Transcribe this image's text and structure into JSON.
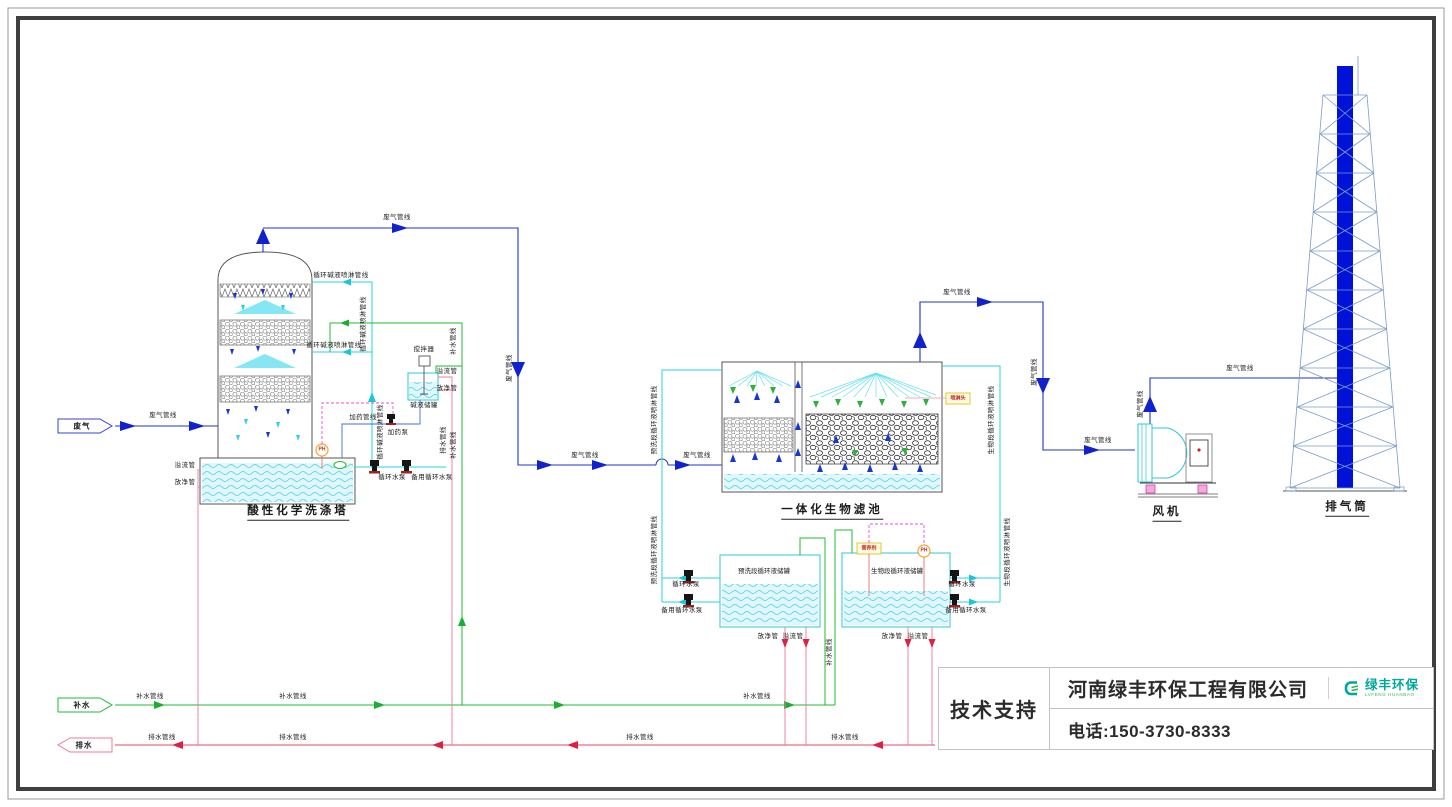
{
  "title_block": {
    "support": "技术支持",
    "company": "河南绿丰环保工程有限公司",
    "phone": "电话:150-3730-8333",
    "logo_text": "绿丰环保",
    "logo_sub": "LVFENG HUANBAO"
  },
  "colors": {
    "gas_line": "#2233cc",
    "circulation_line": "#27d3e0",
    "water_line": "#22bb33",
    "drain_line": "#e8446a",
    "signal_line": "#e24fe2",
    "stack_fill": "#0011d8",
    "logo_teal": "#00a79b",
    "logo_green": "#3ab54a"
  },
  "diagram_labels": [
    {
      "t": "废气",
      "x": 82,
      "y": 426,
      "k": "flag",
      "n": "flag-waste-gas-in"
    },
    {
      "t": "补水",
      "x": 82,
      "y": 705,
      "k": "flag",
      "n": "flag-water-in"
    },
    {
      "t": "排水",
      "x": 84,
      "y": 745,
      "k": "flag",
      "n": "flag-drain-out"
    },
    {
      "t": "废气管线",
      "x": 163,
      "y": 416,
      "n": "gas-line-label"
    },
    {
      "t": "废气管线",
      "x": 397,
      "y": 218,
      "n": "gas-line-label"
    },
    {
      "t": "废气管线",
      "x": 510,
      "y": 368,
      "r": 1,
      "n": "gas-line-label"
    },
    {
      "t": "废气管线",
      "x": 585,
      "y": 456,
      "n": "gas-line-label"
    },
    {
      "t": "废气管线",
      "x": 697,
      "y": 456,
      "n": "gas-line-label"
    },
    {
      "t": "废气管线",
      "x": 957,
      "y": 293,
      "n": "gas-line-label"
    },
    {
      "t": "废气管线",
      "x": 1035,
      "y": 372,
      "r": 1,
      "n": "gas-line-label"
    },
    {
      "t": "废气管线",
      "x": 1098,
      "y": 441,
      "n": "gas-line-label"
    },
    {
      "t": "废气管线",
      "x": 1141,
      "y": 404,
      "r": 1,
      "n": "gas-line-label"
    },
    {
      "t": "废气管线",
      "x": 1240,
      "y": 369,
      "n": "gas-line-label"
    },
    {
      "t": "循环碱液喷淋管线",
      "x": 341,
      "y": 276,
      "n": "alkali-spray-line-label"
    },
    {
      "t": "循环碱液喷淋管线",
      "x": 334,
      "y": 346,
      "n": "alkali-spray-line-label"
    },
    {
      "t": "循环碱液喷淋管线",
      "x": 364,
      "y": 324,
      "r": 1,
      "n": "alkali-spray-line-label"
    },
    {
      "t": "循环碱液喷淋管线",
      "x": 381,
      "y": 432,
      "r": 1,
      "n": "alkali-spray-line-label"
    },
    {
      "t": "补水管线",
      "x": 454,
      "y": 341,
      "r": 1,
      "n": "makeup-water-label"
    },
    {
      "t": "补水管线",
      "x": 454,
      "y": 445,
      "r": 1,
      "n": "makeup-water-label"
    },
    {
      "t": "补水管线",
      "x": 830,
      "y": 652,
      "r": 1,
      "n": "makeup-water-label"
    },
    {
      "t": "补水管线",
      "x": 150,
      "y": 697,
      "n": "makeup-water-label"
    },
    {
      "t": "补水管线",
      "x": 293,
      "y": 697,
      "n": "makeup-water-label"
    },
    {
      "t": "补水管线",
      "x": 757,
      "y": 697,
      "n": "makeup-water-label"
    },
    {
      "t": "排水管线",
      "x": 162,
      "y": 738,
      "n": "drain-line-label"
    },
    {
      "t": "排水管线",
      "x": 293,
      "y": 738,
      "n": "drain-line-label"
    },
    {
      "t": "排水管线",
      "x": 640,
      "y": 738,
      "n": "drain-line-label"
    },
    {
      "t": "排水管线",
      "x": 845,
      "y": 738,
      "n": "drain-line-label"
    },
    {
      "t": "排水管线",
      "x": 444,
      "y": 440,
      "r": 1,
      "n": "drain-line-label"
    },
    {
      "t": "溢流管",
      "x": 185,
      "y": 466,
      "n": "overflow-pipe-label"
    },
    {
      "t": "放净管",
      "x": 185,
      "y": 483,
      "n": "drain-pipe-label"
    },
    {
      "t": "溢流管",
      "x": 447,
      "y": 372,
      "n": "overflow-pipe-label"
    },
    {
      "t": "放净管",
      "x": 447,
      "y": 389,
      "n": "drain-pipe-label"
    },
    {
      "t": "放净管",
      "x": 768,
      "y": 637,
      "n": "drain-pipe-label"
    },
    {
      "t": "溢流管",
      "x": 793,
      "y": 637,
      "n": "overflow-pipe-label"
    },
    {
      "t": "放净管",
      "x": 892,
      "y": 637,
      "n": "drain-pipe-label"
    },
    {
      "t": "溢流管",
      "x": 918,
      "y": 637,
      "n": "overflow-pipe-label"
    },
    {
      "t": "加药管线",
      "x": 363,
      "y": 418,
      "n": "dosing-line-label"
    },
    {
      "t": "加药泵",
      "x": 398,
      "y": 433,
      "n": "dosing-pump-label"
    },
    {
      "t": "搅拌器",
      "x": 424,
      "y": 350,
      "n": "agitator-label"
    },
    {
      "t": "碱液储罐",
      "x": 424,
      "y": 406,
      "n": "alkali-tank-label"
    },
    {
      "t": "循环水泵",
      "x": 392,
      "y": 478,
      "n": "pump-label"
    },
    {
      "t": "备用循环水泵",
      "x": 432,
      "y": 478,
      "n": "pump-label"
    },
    {
      "t": "循环水泵",
      "x": 686,
      "y": 585,
      "n": "pump-label"
    },
    {
      "t": "备用循环水泵",
      "x": 682,
      "y": 611,
      "n": "pump-label"
    },
    {
      "t": "循环水泵",
      "x": 962,
      "y": 585,
      "n": "pump-label"
    },
    {
      "t": "备用循环水泵",
      "x": 966,
      "y": 611,
      "n": "pump-label"
    },
    {
      "t": "预洗段循环液喷淋管线",
      "x": 655,
      "y": 420,
      "r": 1,
      "n": "prewash-spray-line-label"
    },
    {
      "t": "预洗段循环液喷淋管线",
      "x": 655,
      "y": 550,
      "r": 1,
      "n": "prewash-spray-line-label"
    },
    {
      "t": "生物段循环液喷淋管线",
      "x": 992,
      "y": 420,
      "r": 1,
      "n": "bio-spray-line-label"
    },
    {
      "t": "生物段循环液喷淋管线",
      "x": 1008,
      "y": 552,
      "r": 1,
      "n": "bio-spray-line-label"
    },
    {
      "t": "预洗段循环液储罐",
      "x": 764,
      "y": 572,
      "k": "tank",
      "n": "prewash-tank-label"
    },
    {
      "t": "生物段循环液储罐",
      "x": 897,
      "y": 572,
      "k": "tank",
      "n": "bio-tank-label"
    },
    {
      "t": "酸性化学洗涤塔",
      "x": 298,
      "y": 513,
      "k": "title",
      "n": "equipment-title-scrubber"
    },
    {
      "t": "一体化生物滤池",
      "x": 832,
      "y": 512,
      "k": "title",
      "n": "equipment-title-biofilter"
    },
    {
      "t": "风机",
      "x": 1167,
      "y": 514,
      "k": "title",
      "n": "equipment-title-fan"
    },
    {
      "t": "排气筒",
      "x": 1347,
      "y": 509,
      "k": "title",
      "n": "equipment-title-stack"
    },
    {
      "t": "喷淋头",
      "x": 958,
      "y": 399,
      "c": "#cc2222",
      "k": "tag",
      "n": "spray-nozzle-tag"
    },
    {
      "t": "营养剂",
      "x": 869,
      "y": 549,
      "c": "#cc2222",
      "k": "tag",
      "n": "nutrient-tag"
    },
    {
      "t": "PH",
      "x": 322,
      "y": 450,
      "c": "#cc2222",
      "k": "tag",
      "n": "ph-meter-tag"
    },
    {
      "t": "PH",
      "x": 924,
      "y": 551,
      "c": "#cc2222",
      "k": "tag",
      "n": "ph-meter-tag"
    }
  ]
}
